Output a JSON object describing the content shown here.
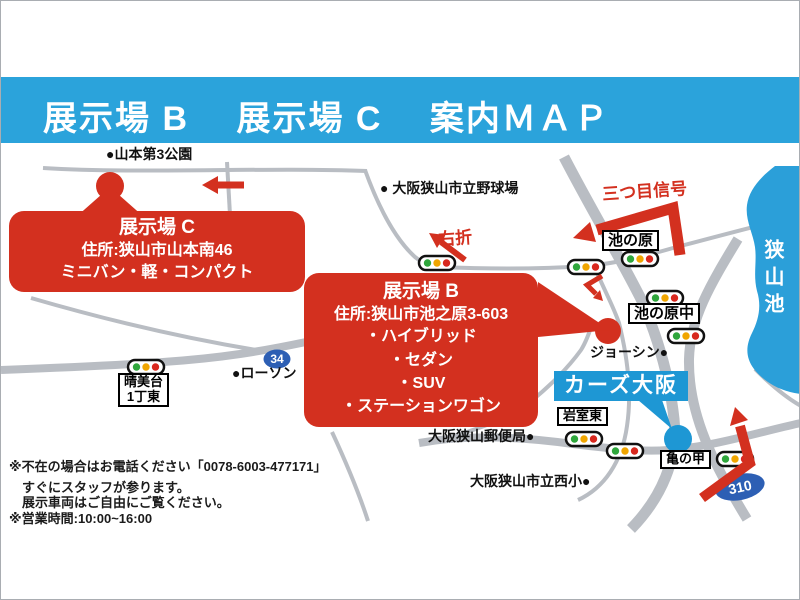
{
  "header": {
    "title": "展示場 B　 展示場 C　 案内ＭＡＰ"
  },
  "callouts": {
    "site_c": {
      "title": "展示場 C",
      "address": "住所:狭山市山本南46",
      "vehicles": "ミニバン・軽・コンパクト"
    },
    "site_b": {
      "title": "展示場 B",
      "address": "住所:狭山市池之原3-603",
      "vehicles": [
        "・ハイブリッド",
        "・セダン",
        "・SUV",
        "・ステーションワゴン"
      ]
    }
  },
  "dealer": {
    "name": "カーズ大阪"
  },
  "map_labels": {
    "park": "●山本第3公園",
    "baseball": "● 大阪狭山市立野球場",
    "joshin": "ジョーシン●",
    "post_office": "大阪狭山郵便局●",
    "elementary": "大阪狭山市立西小●",
    "lawson": "●ローソン",
    "lake": "狭山池",
    "right_turn": "右折",
    "third_signal": "三つ目信号"
  },
  "intersections": {
    "ikenohara": "池の原",
    "ikenohara_naka": "池の原中",
    "harumidai_line1": "晴美台",
    "harumidai_line2": "1丁東",
    "iwamuro_higashi": "岩室東",
    "kamenoko": "亀の甲"
  },
  "routes": {
    "r34": "34",
    "r310": "310"
  },
  "notes": {
    "line1": "※不在の場合はお電話ください「0078-6003-477171」",
    "line2": "すぐにスタッフが参ります。",
    "line3": "展示車両はご自由にご覧ください。",
    "line4": "※営業時間:10:00~16:00"
  },
  "colors": {
    "banner_blue": "#2ba3db",
    "map_red": "#d3301f",
    "lake_blue": "#2b9fd9",
    "dealer_blue": "#1e97d4",
    "route_badge_blue": "#2d5fb4",
    "road_gray": "#b9bdc3"
  }
}
